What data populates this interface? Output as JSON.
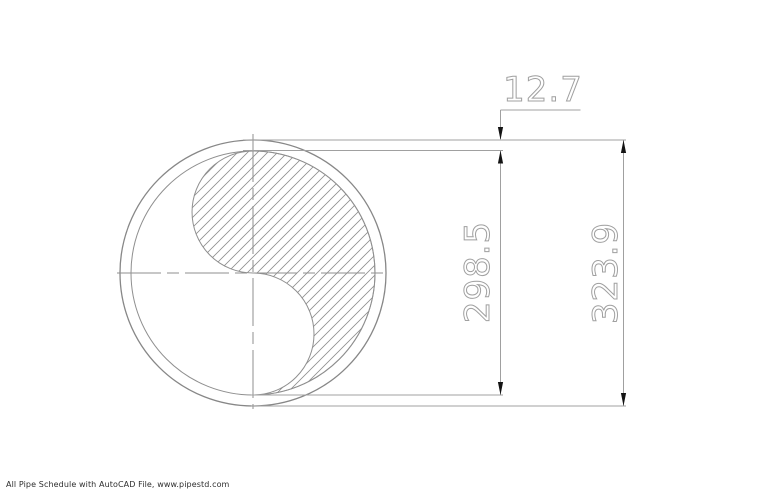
{
  "page": {
    "background": "#ffffff"
  },
  "drawing": {
    "type": "pipe-cross-section",
    "dimensions": {
      "wall_thickness": "12.7",
      "inner_diameter": "298.5",
      "outer_diameter": "323.9"
    },
    "colors": {
      "geometry_line": "#8f8f8f",
      "dimension_line": "#a0a0a0",
      "arrow": "#141414",
      "dimension_text": "#a0a0a0",
      "footer_text": "#2e2e2e"
    }
  },
  "footer": {
    "caption": "All Pipe Schedule with AutoCAD File, www.pipestd.com"
  }
}
